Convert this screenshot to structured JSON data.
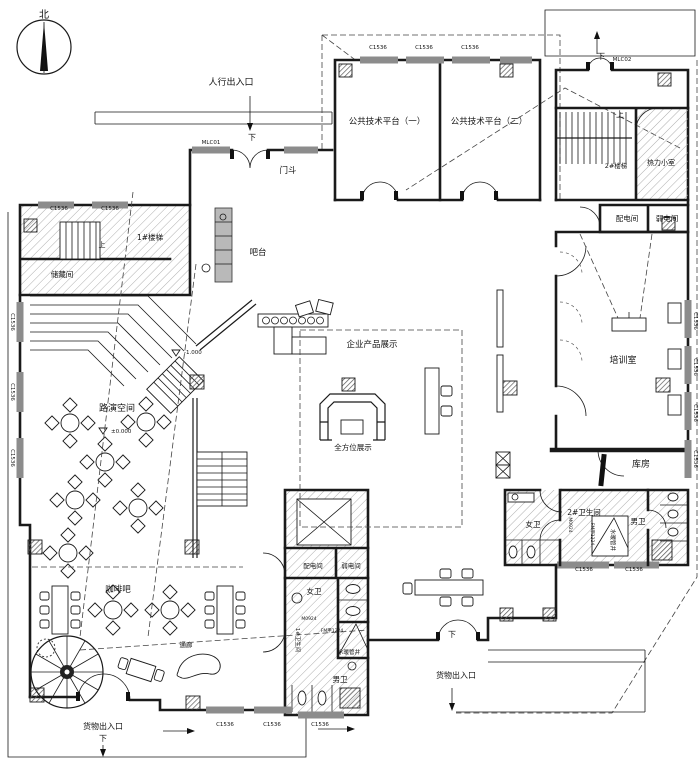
{
  "drawing_type": "architectural floor plan",
  "colors": {
    "line": "#1a1a1a",
    "wall": "#1a1a1a",
    "window": "#8c8c8c",
    "hatch": "#9a9a9a",
    "paper": "#ffffff"
  },
  "compass": {
    "label": "北"
  },
  "entrances": {
    "pedestrian": "人行出入口",
    "goods_southwest": "货物出入口",
    "goods_south": "货物出入口"
  },
  "rooms": {
    "vestibule": "门斗",
    "platform1": "公共技术平台（一）",
    "platform2": "公共技术平台（二）",
    "stair1": "1#楼梯",
    "stair2": "2#楼梯",
    "storage_small": "储藏间",
    "heating_room": "热力小室",
    "power_room": "配电间",
    "lowvolt_room": "弱电间",
    "training_room": "培训室",
    "warehouse": "库房",
    "roadshow_space": "路演空间",
    "coffee_bar": "咖啡吧",
    "bar_counter": "吧台",
    "product_display": "企业产品展示",
    "allround_display": "全方位展示",
    "restroom1": "1#卫生间",
    "restroom2": "2#卫生间",
    "womens": "女卫",
    "mens": "男卫",
    "pipe_shaft": "水暖管井",
    "corridor": "通廊"
  },
  "elevations": {
    "upper": "-1.000",
    "ground": "±0.000"
  },
  "window_tag": "C1536",
  "door_tags": [
    "MLC01",
    "MLC02",
    "M0924",
    "FM甲1224"
  ],
  "direction_marks": [
    "上",
    "下"
  ],
  "plan_labels": [
    {
      "name": "north-label",
      "text": "北",
      "x": 44,
      "y": 18,
      "size": 10
    },
    {
      "name": "pedestrian-entrance-label",
      "text": "人行出入口",
      "x": 231,
      "y": 85,
      "size": 9
    },
    {
      "name": "down-mark-1",
      "text": "下",
      "x": 252,
      "y": 140,
      "size": 8
    },
    {
      "name": "door-tag-mlc01",
      "text": "MLC01",
      "x": 211,
      "y": 144,
      "size": 5.5
    },
    {
      "name": "vestibule-label",
      "text": "门斗",
      "x": 288,
      "y": 173,
      "size": 8.5
    },
    {
      "name": "window-tag-top-1",
      "text": "C1536",
      "x": 378,
      "y": 49,
      "size": 5.5
    },
    {
      "name": "window-tag-top-2",
      "text": "C1536",
      "x": 424,
      "y": 49,
      "size": 5.5
    },
    {
      "name": "window-tag-top-3",
      "text": "C1536",
      "x": 470,
      "y": 49,
      "size": 5.5
    },
    {
      "name": "platform1-label",
      "text": "公共技术平台（一）",
      "x": 387,
      "y": 124,
      "size": 8.5
    },
    {
      "name": "platform2-label",
      "text": "公共技术平台（二）",
      "x": 489,
      "y": 124,
      "size": 8.5
    },
    {
      "name": "door-tag-mlc02",
      "text": "MLC02",
      "x": 622,
      "y": 61,
      "size": 5.5
    },
    {
      "name": "down-mark-2",
      "text": "下",
      "x": 601,
      "y": 59,
      "size": 8
    },
    {
      "name": "up-mark-2",
      "text": "上",
      "x": 620,
      "y": 117,
      "size": 8
    },
    {
      "name": "stair2-label",
      "text": "2#楼梯",
      "x": 616,
      "y": 168,
      "size": 6.5
    },
    {
      "name": "heating-room-label",
      "text": "热力小室",
      "x": 661,
      "y": 165,
      "size": 7
    },
    {
      "name": "power-room2-label",
      "text": "配电间",
      "x": 627,
      "y": 221,
      "size": 7.5
    },
    {
      "name": "lowvolt-room2-label",
      "text": "弱电间",
      "x": 667,
      "y": 221,
      "size": 7.5
    },
    {
      "name": "training-room-label",
      "text": "培训室",
      "x": 623,
      "y": 363,
      "size": 9
    },
    {
      "name": "warehouse-label",
      "text": "库房",
      "x": 641,
      "y": 467,
      "size": 9
    },
    {
      "name": "restroom2-label",
      "text": "2#卫生间",
      "x": 584,
      "y": 515,
      "size": 7.5
    },
    {
      "name": "womens2-label",
      "text": "女卫",
      "x": 533,
      "y": 527,
      "size": 7.5
    },
    {
      "name": "mens2-label",
      "text": "男卫",
      "x": 638,
      "y": 524,
      "size": 7.5
    },
    {
      "name": "pipe-shaft2-label",
      "text": "水暖管井",
      "x": 611,
      "y": 540,
      "size": 5.5,
      "rot": 90
    },
    {
      "name": "door-tag-m0924-r2",
      "text": "M0924",
      "x": 569,
      "y": 525,
      "size": 4.5,
      "rot": 90
    },
    {
      "name": "door-tag-fm1224-r2",
      "text": "FM甲1224",
      "x": 591,
      "y": 534,
      "size": 4.5,
      "rot": 90
    },
    {
      "name": "window-tag-b4",
      "text": "C1536",
      "x": 584,
      "y": 571,
      "size": 5.5
    },
    {
      "name": "window-tag-b5",
      "text": "C1536",
      "x": 634,
      "y": 571,
      "size": 5.5
    },
    {
      "name": "window-tag-r1",
      "text": "C1536",
      "x": 694,
      "y": 321,
      "size": 5.5,
      "rot": 90
    },
    {
      "name": "window-tag-r2",
      "text": "C1536",
      "x": 694,
      "y": 367,
      "size": 5.5,
      "rot": 90
    },
    {
      "name": "window-tag-r3",
      "text": "C1536",
      "x": 694,
      "y": 413,
      "size": 5.5,
      "rot": 90
    },
    {
      "name": "window-tag-r4",
      "text": "C1536",
      "x": 694,
      "y": 459,
      "size": 5.5,
      "rot": 90
    },
    {
      "name": "window-tag-nw1",
      "text": "C1536",
      "x": 59,
      "y": 210,
      "size": 5.5
    },
    {
      "name": "window-tag-nw2",
      "text": "C1536",
      "x": 110,
      "y": 210,
      "size": 5.5
    },
    {
      "name": "stair1-label",
      "text": "1#楼梯",
      "x": 150,
      "y": 240,
      "size": 7.5
    },
    {
      "name": "up-mark-1",
      "text": "上",
      "x": 102,
      "y": 247,
      "size": 7
    },
    {
      "name": "storage-small-label",
      "text": "储藏间",
      "x": 62,
      "y": 277,
      "size": 7.5
    },
    {
      "name": "window-tag-wl1",
      "text": "C1536",
      "x": 11,
      "y": 322,
      "size": 5.5,
      "rot": 90
    },
    {
      "name": "window-tag-wl2",
      "text": "C1536",
      "x": 11,
      "y": 392,
      "size": 5.5,
      "rot": 90
    },
    {
      "name": "window-tag-wl3",
      "text": "C1536",
      "x": 11,
      "y": 458,
      "size": 5.5,
      "rot": 90
    },
    {
      "name": "roadshow-label",
      "text": "路演空间",
      "x": 117,
      "y": 411,
      "size": 9
    },
    {
      "name": "elevation-upper",
      "text": "-1.000",
      "x": 184,
      "y": 354,
      "size": 5.5,
      "anchor": "start"
    },
    {
      "name": "elevation-zero",
      "text": "±0.000",
      "x": 111,
      "y": 433,
      "size": 5.5,
      "anchor": "start"
    },
    {
      "name": "bar-counter-label",
      "text": "吧台",
      "x": 258,
      "y": 255,
      "size": 8.5
    },
    {
      "name": "product-display-label",
      "text": "企业产品展示",
      "x": 372,
      "y": 347,
      "size": 8.5
    },
    {
      "name": "allround-display-label",
      "text": "全方位展示",
      "x": 353,
      "y": 450,
      "size": 7.5
    },
    {
      "name": "coffee-bar-label",
      "text": "咖啡吧",
      "x": 118,
      "y": 592,
      "size": 8.5
    },
    {
      "name": "corridor-label",
      "text": "通廊",
      "x": 186,
      "y": 647,
      "size": 6.5
    },
    {
      "name": "goods-entrance-sw-label",
      "text": "货物出入口",
      "x": 103,
      "y": 729,
      "size": 8
    },
    {
      "name": "down-mark-3",
      "text": "下",
      "x": 103,
      "y": 741,
      "size": 8
    },
    {
      "name": "window-tag-b1",
      "text": "C1536",
      "x": 225,
      "y": 726,
      "size": 5.5
    },
    {
      "name": "window-tag-b2",
      "text": "C1536",
      "x": 272,
      "y": 726,
      "size": 5.5
    },
    {
      "name": "window-tag-b3",
      "text": "C1536",
      "x": 320,
      "y": 726,
      "size": 5.5
    },
    {
      "name": "power-room1-label",
      "text": "配电间",
      "x": 313,
      "y": 568,
      "size": 6.5
    },
    {
      "name": "lowvolt-room1-label",
      "text": "弱电间",
      "x": 351,
      "y": 568,
      "size": 6.5
    },
    {
      "name": "womens1-label",
      "text": "女卫",
      "x": 314,
      "y": 594,
      "size": 7.5
    },
    {
      "name": "restroom1-label",
      "text": "1#卫生间",
      "x": 296,
      "y": 640,
      "size": 5.5,
      "rot": 90
    },
    {
      "name": "door-tag-m0924-r1",
      "text": "M0924",
      "x": 309,
      "y": 620,
      "size": 4.5
    },
    {
      "name": "door-tag-fm1224-r1",
      "text": "FM甲1224",
      "x": 332,
      "y": 632,
      "size": 4.5
    },
    {
      "name": "pipe-shaft1-label",
      "text": "水暖管井",
      "x": 349,
      "y": 654,
      "size": 5.5
    },
    {
      "name": "mens1-label",
      "text": "男卫",
      "x": 340,
      "y": 682,
      "size": 7.5
    },
    {
      "name": "goods-entrance-s-label",
      "text": "货物出入口",
      "x": 456,
      "y": 678,
      "size": 8
    },
    {
      "name": "down-mark-4",
      "text": "下",
      "x": 452,
      "y": 637,
      "size": 8
    }
  ]
}
